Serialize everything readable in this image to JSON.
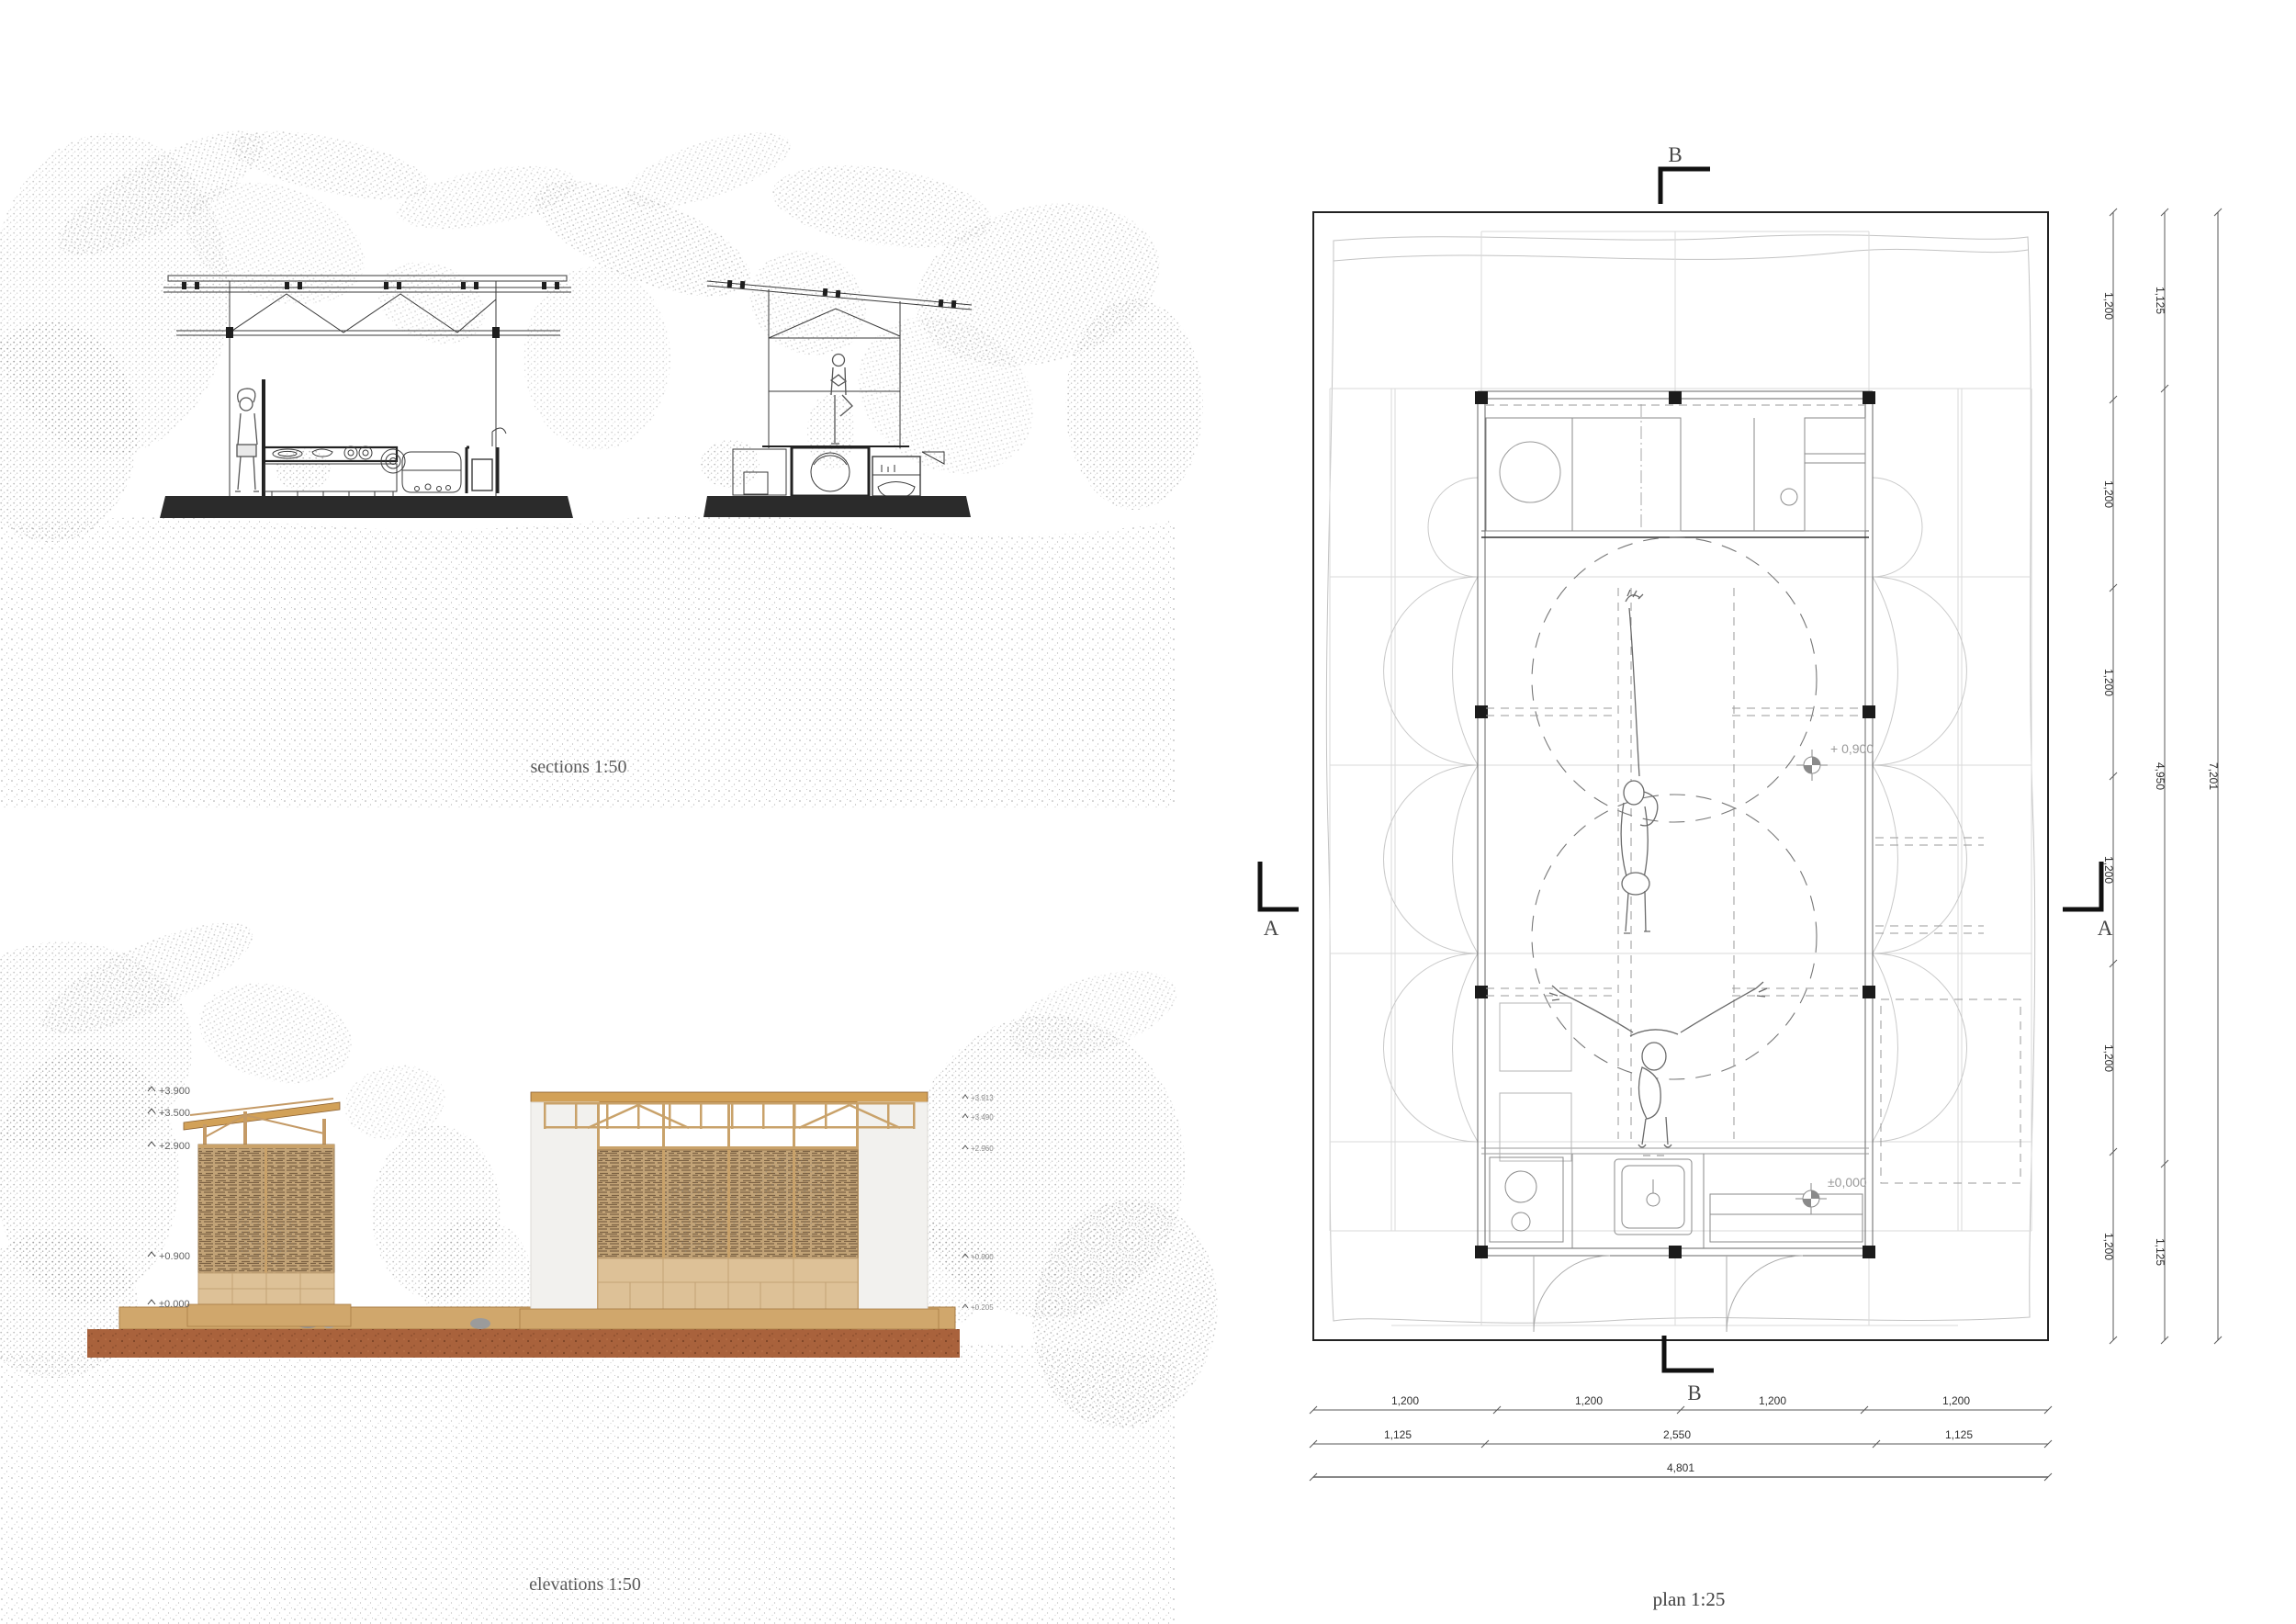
{
  "sections": {
    "caption": "sections 1:50"
  },
  "elevations": {
    "caption": "elevations 1:50",
    "levels_left": [
      "+3.900",
      "+3.500",
      "+2.900",
      "+0.900",
      "±0.000"
    ],
    "levels_right": [
      "+3.913",
      "+3.490",
      "+2.960",
      "+0.900",
      "+0.205"
    ]
  },
  "plan": {
    "caption": "plan 1:25",
    "markers": {
      "section_a": "A",
      "section_b": "B"
    },
    "levels": {
      "upper": "+ 0,900",
      "ground": "±0,000"
    },
    "dims": {
      "right_inner": [
        "1,200",
        "1,200",
        "1,200",
        "1,200",
        "1,200",
        "1,200"
      ],
      "right_mid": [
        "1,125",
        "4,950",
        "1,125"
      ],
      "right_total": "7,201",
      "bottom_top": [
        "1,200",
        "1,200",
        "1,200",
        "1,200"
      ],
      "bottom_mid": [
        "1,125",
        "2,550",
        "1,125"
      ],
      "bottom_total": "4,801"
    }
  },
  "colors": {
    "wood": "#d2a158",
    "bamboo": "#c2a377",
    "soil": "#a9623c",
    "slab": "#2b2b2b",
    "ink": "#2f2f2f",
    "faint": "#d9d9d9"
  }
}
